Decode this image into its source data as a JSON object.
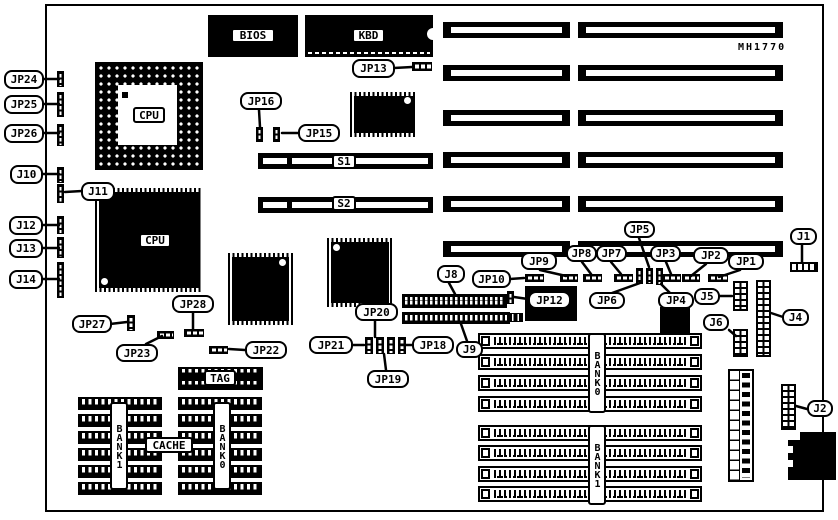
{
  "board": {
    "part_number": "MH1770"
  },
  "chips": {
    "bios": "BIOS",
    "kbd": "KBD",
    "cpu_socket": "CPU",
    "cpu_qfp": "CPU",
    "s1": "S1",
    "s2": "S2",
    "tag": "TAG",
    "cache": "CACHE",
    "cache_bank1": "BANK1",
    "cache_bank0": "BANK0",
    "simm_bank0": "BANK0",
    "simm_bank1": "BANK1"
  },
  "callouts": {
    "jp24": "JP24",
    "jp25": "JP25",
    "jp26": "JP26",
    "j10": "J10",
    "j11": "J11",
    "j12": "J12",
    "j13": "J13",
    "j14": "J14",
    "jp27": "JP27",
    "jp23": "JP23",
    "jp28": "JP28",
    "jp22": "JP22",
    "jp16": "JP16",
    "jp15": "JP15",
    "jp13": "JP13",
    "jp20": "JP20",
    "jp21": "JP21",
    "jp18": "JP18",
    "jp19": "JP19",
    "j8": "J8",
    "j9": "J9",
    "jp10": "JP10",
    "jp12": "JP12",
    "jp9": "JP9",
    "jp8": "JP8",
    "jp7": "JP7",
    "jp5": "JP5",
    "jp6": "JP6",
    "jp4": "JP4",
    "jp3": "JP3",
    "jp2": "JP2",
    "jp1": "JP1",
    "j1": "J1",
    "j5": "J5",
    "j6": "J6",
    "j4": "J4",
    "j2": "J2"
  },
  "memory": {
    "simm_bank0_sockets": 4,
    "simm_bank1_sockets": 4,
    "cache_rows_per_bank": 6,
    "isa_slots": 6
  }
}
